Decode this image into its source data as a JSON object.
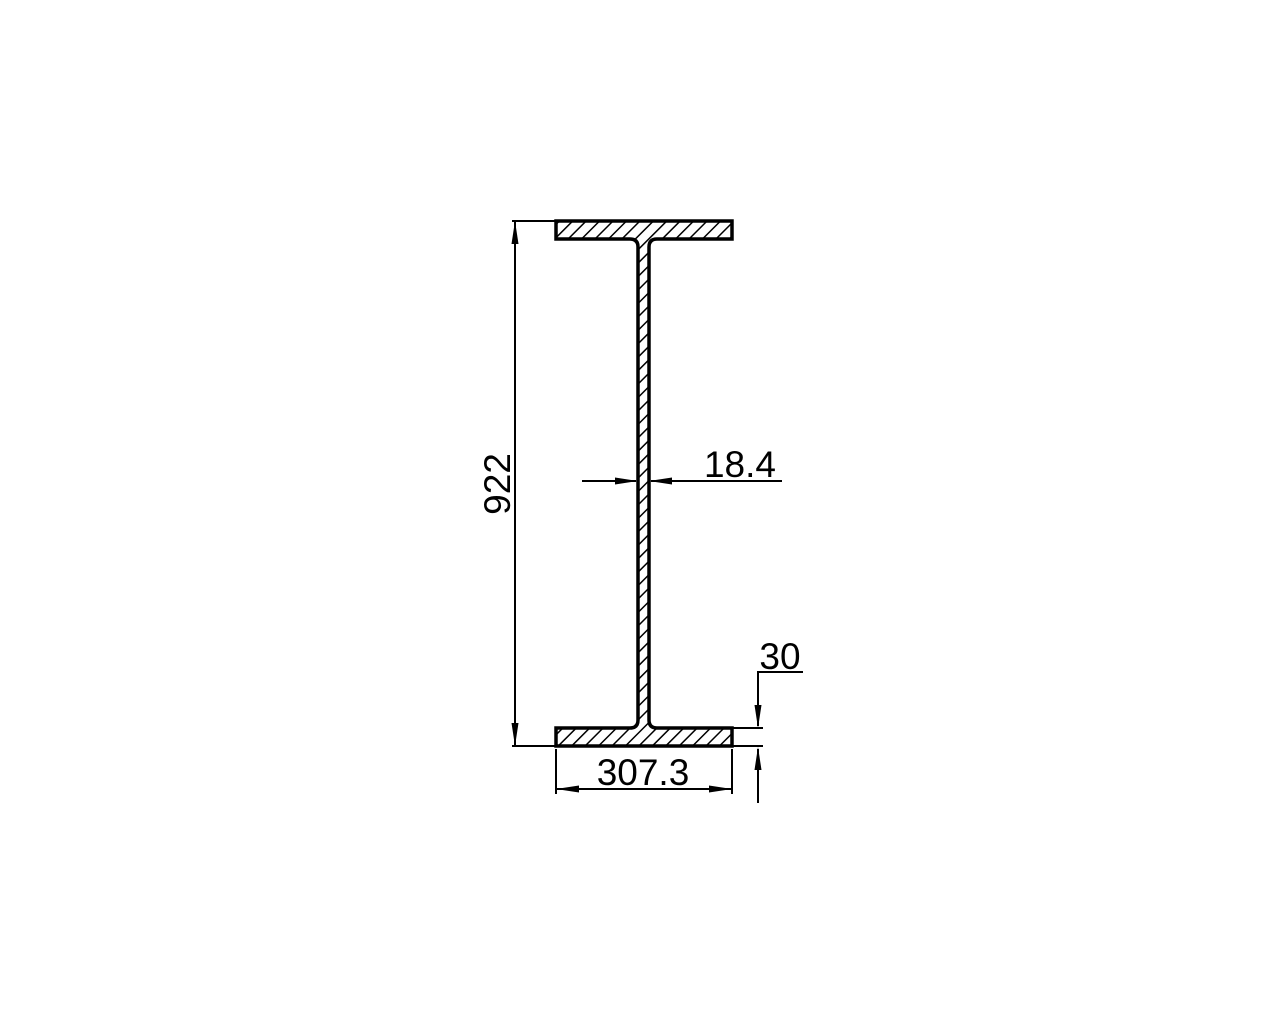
{
  "drawing": {
    "type": "I-beam cross-section engineering drawing",
    "background_color": "#ffffff",
    "line_color": "#000000",
    "dimensions": {
      "overall_height": "922",
      "web_thickness": "18.4",
      "flange_thickness": "30",
      "flange_width": "307.3"
    }
  }
}
